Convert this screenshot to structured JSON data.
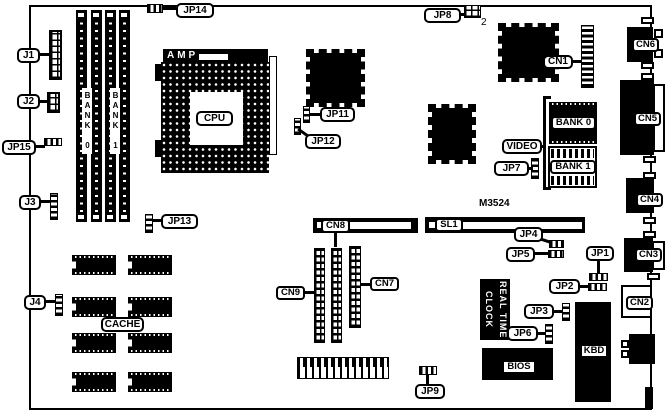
{
  "page": {
    "background": "#ffffff",
    "ink": "#000000"
  },
  "board": {
    "model": "M3524",
    "cpu": {
      "label": "CPU",
      "socket_brand": "AMP"
    },
    "simm": {
      "bank0": "BANK 0",
      "bank1": "BANK 1"
    },
    "cache": {
      "label": "CACHE"
    },
    "video": {
      "label": "VIDEO",
      "bank0": "BANK 0",
      "bank1": "BANK 1"
    },
    "rtc": {
      "line1": "REAL TIME",
      "line2": "CLOCK"
    },
    "bios": {
      "label": "BIOS"
    },
    "kbd": {
      "label": "KBD"
    },
    "slot": {
      "sl1": "SL1"
    },
    "connectors": {
      "j1": "J1",
      "j2": "J2",
      "j3": "J3",
      "j4": "J4",
      "cn1": "CN1",
      "cn2": "CN2",
      "cn3": "CN3",
      "cn4": "CN4",
      "cn5": "CN5",
      "cn6": "CN6",
      "cn7": "CN7",
      "cn8": "CN8",
      "cn9": "CN9"
    },
    "jumpers": {
      "jp1": "JP1",
      "jp2": "JP2",
      "jp3": "JP3",
      "jp4": "JP4",
      "jp5": "JP5",
      "jp6": "JP6",
      "jp7": "JP7",
      "jp8": "JP8",
      "jp8_pin": "2",
      "jp9": "JP9",
      "jp11": "JP11",
      "jp12": "JP12",
      "jp13": "JP13",
      "jp14": "JP14",
      "jp15": "JP15"
    }
  }
}
